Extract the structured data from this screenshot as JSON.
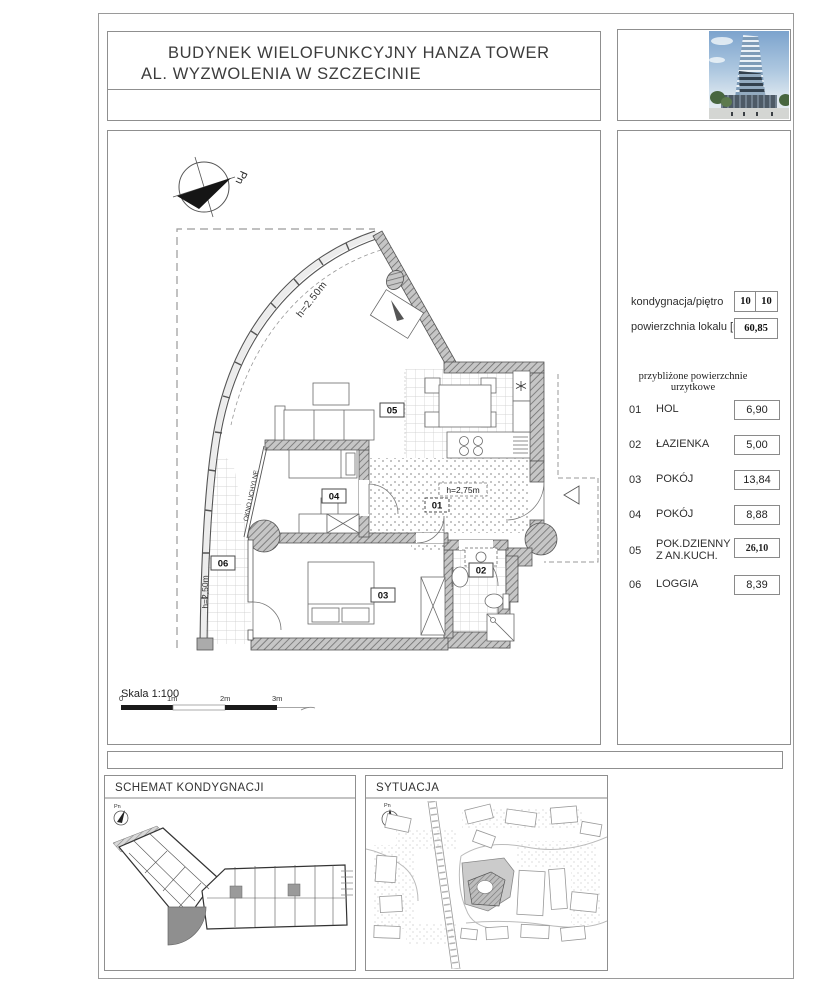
{
  "header": {
    "title_line1": "BUDYNEK WIELOFUNKCYJNY HANZA TOWER",
    "title_line2": "AL. WYZWOLENIA  W SZCZECINIE"
  },
  "info": {
    "floor_label": "kondygnacja/piętro",
    "floor_value_1": "10",
    "floor_value_2": "10",
    "area_label": "powierzchnia lokalu [m²]",
    "area_value": "60,85",
    "table_title": "przybliżone  powierzchnie urzytkowe",
    "rooms": [
      {
        "no": "01",
        "name": "HOL",
        "area": "6,90"
      },
      {
        "no": "02",
        "name": "ŁAZIENKA",
        "area": "5,00"
      },
      {
        "no": "03",
        "name": "POKÓJ",
        "area": "13,84"
      },
      {
        "no": "04",
        "name": "POKÓJ",
        "area": "8,88"
      },
      {
        "no": "05",
        "name": "POK.DZIENNY Z AN.KUCH.",
        "area": "26,10"
      },
      {
        "no": "06",
        "name": "LOGGIA",
        "area": "8,39"
      }
    ]
  },
  "plan": {
    "compass_label": "Pn",
    "labels": {
      "r01": "01",
      "r02": "02",
      "r03": "03",
      "r04": "04",
      "r05": "05",
      "r06": "06"
    },
    "annotations": {
      "facade_height": "h=2.50m",
      "hall_height": "h=2,75m",
      "loggia_height": "h=2,50m",
      "window_note": "OKNO UCHYLNE"
    },
    "scale": {
      "label": "Skala 1:100",
      "tick0": "0",
      "tick1": "1m",
      "tick2": "2m",
      "tick3": "3m"
    }
  },
  "panels": {
    "schemat_title": "SCHEMAT KONDYGNACJI",
    "schemat_compass": "Pn",
    "sytuacja_title": "SYTUACJA",
    "sytuacja_compass": "Pn"
  }
}
